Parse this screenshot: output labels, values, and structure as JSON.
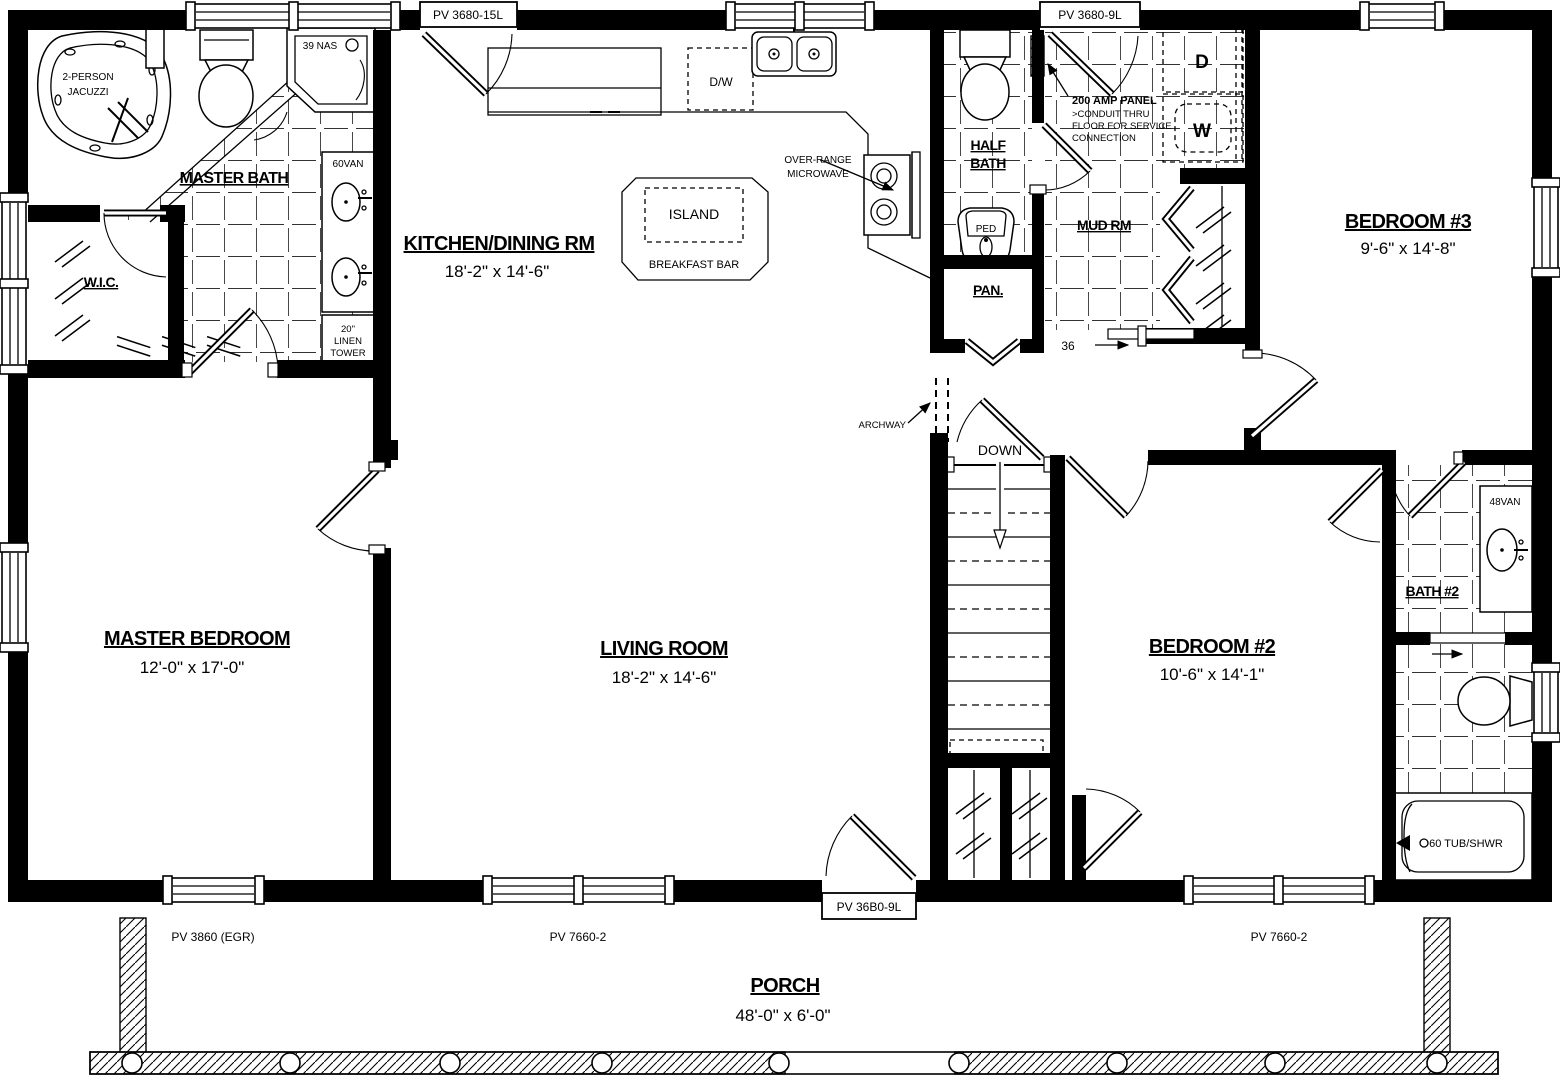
{
  "plan": {
    "rooms": {
      "master_bath": {
        "name": "MASTER BATH"
      },
      "wic": {
        "name": "W.I.C."
      },
      "master_bedroom": {
        "name": "MASTER BEDROOM",
        "dims": "12'-0\" x 17'-0\""
      },
      "kitchen": {
        "name": "KITCHEN/DINING RM",
        "dims": "18'-2\" x 14'-6\""
      },
      "living": {
        "name": "LIVING ROOM",
        "dims": "18'-2\" x 14'-6\""
      },
      "half_bath": {
        "line1": "HALF",
        "line2": "BATH"
      },
      "pantry": {
        "name": "PAN."
      },
      "mud_room": {
        "name": "MUD RM"
      },
      "bedroom3": {
        "name": "BEDROOM #3",
        "dims": "9'-6\" x 14'-8\""
      },
      "bedroom2": {
        "name": "BEDROOM #2",
        "dims": "10'-6\" x 14'-1\""
      },
      "bath2": {
        "name": "BATH #2"
      },
      "porch": {
        "name": "PORCH",
        "dims": "48'-0\" x 6'-0\""
      }
    },
    "fixtures": {
      "jacuzzi_line1": "2-PERSON",
      "jacuzzi_line2": "JACUZZI",
      "shower": "39 NAS",
      "master_vanity": "60VAN",
      "linen_line1": "20\"",
      "linen_line2": "LINEN",
      "linen_line3": "TOWER",
      "dishwasher": "D/W",
      "island": "ISLAND",
      "breakfast_bar": "BREAKFAST BAR",
      "microwave_line1": "OVER-RANGE",
      "microwave_line2": "MICROWAVE",
      "ped_sink": "PED",
      "dryer": "D",
      "washer": "W",
      "bath2_vanity": "48VAN",
      "tub": "60 TUB/SHWR"
    },
    "annotations": {
      "panel_line1": "200 AMP PANEL",
      "panel_line2": ">CONDUIT THRU",
      "panel_line3": "FLOOR FOR SERVICE",
      "panel_line4": "CONNECTION",
      "archway": "ARCHWAY",
      "down": "DOWN",
      "door_width": "36"
    },
    "openings": {
      "top_left_door": "PV 3680-15L",
      "top_right_door": "PV 3680-9L",
      "bottom_left_window": "PV 3860 (EGR)",
      "bottom_center_window": "PV 7660-2",
      "bottom_door": "PV 36B0-9L",
      "bottom_right_window": "PV 7660-2"
    }
  }
}
